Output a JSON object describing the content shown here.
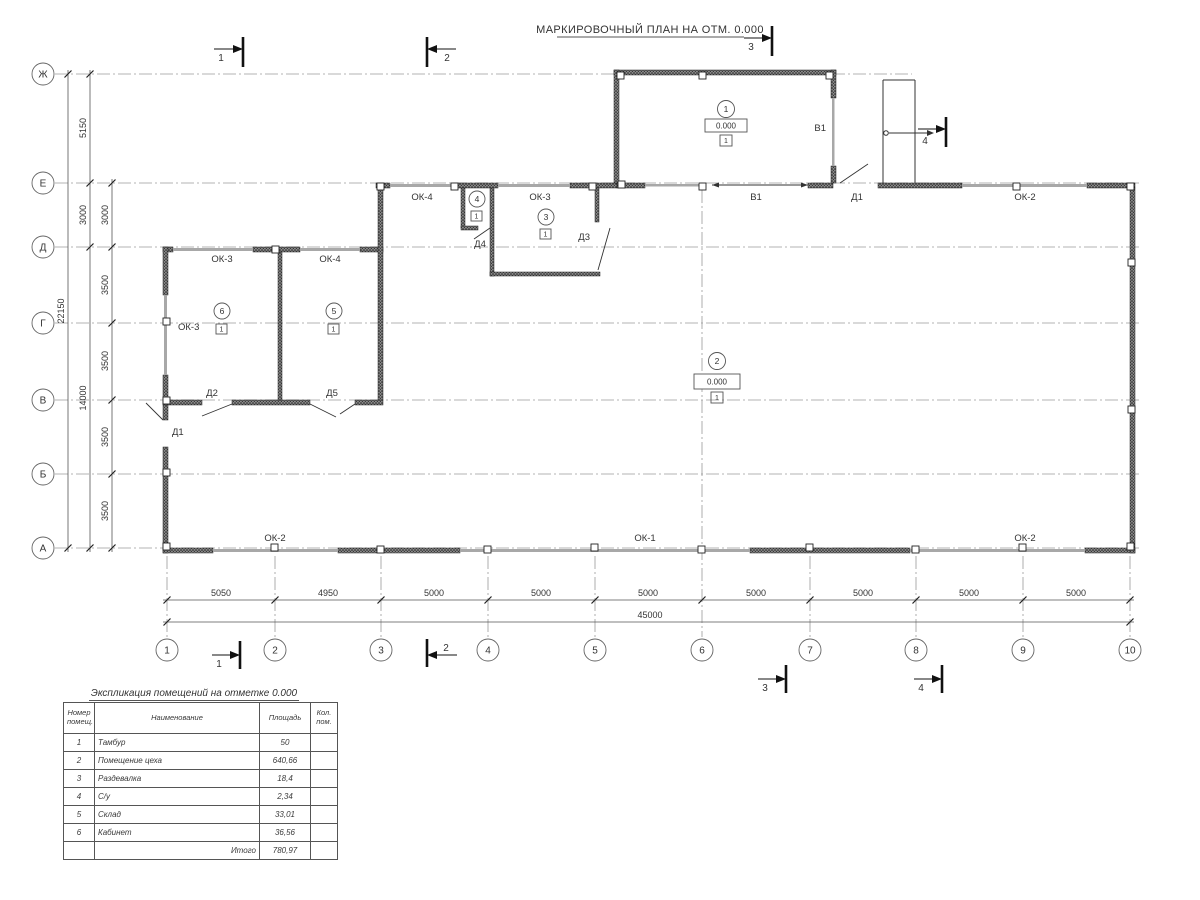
{
  "plan": {
    "title": "МАРКИРОВОЧНЫЙ ПЛАН НА ОТМ. 0.000"
  },
  "axes": {
    "rows": [
      "Ж",
      "Е",
      "Д",
      "Г",
      "В",
      "Б",
      "А"
    ],
    "cols": [
      "1",
      "2",
      "3",
      "4",
      "5",
      "6",
      "7",
      "8",
      "9",
      "10"
    ]
  },
  "dimensions": {
    "vertical_total": "22150",
    "vertical_outer": [
      "5150",
      "3000",
      "14000"
    ],
    "vertical_inner": [
      "3000",
      "3500",
      "3500",
      "3500",
      "3500"
    ],
    "horizontal": [
      "5050",
      "4950",
      "5000",
      "5000",
      "5000",
      "5000",
      "5000",
      "5000",
      "5000"
    ],
    "horizontal_total": "45000"
  },
  "sections": {
    "s1": "1",
    "s2": "2",
    "s3": "3",
    "s4": "4"
  },
  "marks": {
    "windows": {
      "ok1": "ОК-1",
      "ok2": "ОК-2",
      "ok3": "ОК-3",
      "ok4": "ОК-4"
    },
    "doors": {
      "d1": "Д1",
      "d2": "Д2",
      "d3": "Д3",
      "d4": "Д4",
      "d5": "Д5"
    },
    "gates": {
      "v1": "В1"
    }
  },
  "rooms": [
    {
      "num": "1",
      "elevation": "0.000",
      "floor": "1"
    },
    {
      "num": "2",
      "elevation": "0.000",
      "floor": "1"
    },
    {
      "num": "3",
      "floor": "1"
    },
    {
      "num": "4",
      "floor": "1"
    },
    {
      "num": "5",
      "floor": "1"
    },
    {
      "num": "6",
      "floor": "1"
    }
  ],
  "table": {
    "title": "Экспликация помещений на отметке 0.000",
    "headers": {
      "num": "Номер помещ.",
      "name": "Наименование",
      "area": "Площадь",
      "count": "Кол. пом."
    },
    "rows": [
      {
        "num": "1",
        "name": "Тамбур",
        "area": "50",
        "count": ""
      },
      {
        "num": "2",
        "name": "Помещение цеха",
        "area": "640,66",
        "count": ""
      },
      {
        "num": "3",
        "name": "Раздевалка",
        "area": "18,4",
        "count": ""
      },
      {
        "num": "4",
        "name": "С/у",
        "area": "2,34",
        "count": ""
      },
      {
        "num": "5",
        "name": "Склад",
        "area": "33,01",
        "count": ""
      },
      {
        "num": "6",
        "name": "Кабинет",
        "area": "36,56",
        "count": ""
      }
    ],
    "total_label": "Итого",
    "total_value": "780,97"
  }
}
